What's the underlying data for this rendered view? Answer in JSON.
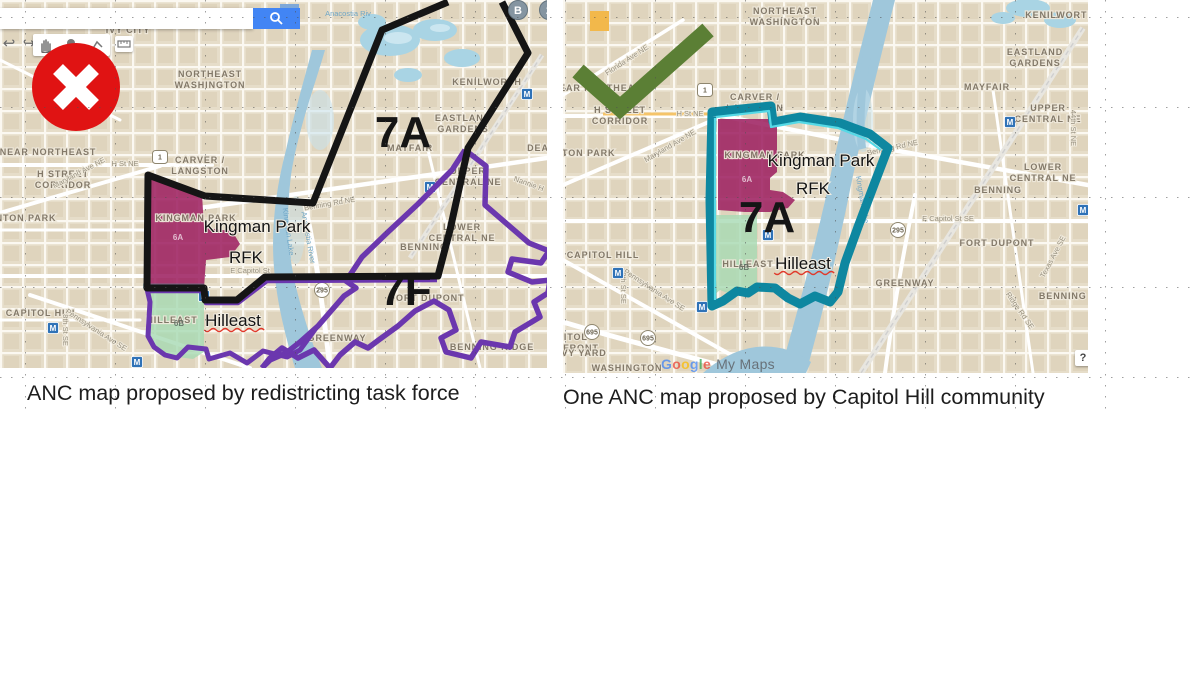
{
  "captions": {
    "left": "ANC map proposed by redistricting task force",
    "right": "One ANC map proposed by Capitol Hill community"
  },
  "verdict_icons": {
    "left": "x-mark",
    "right": "check-mark"
  },
  "colors": {
    "land": "#E6DDC9",
    "water": "#9FC7DB",
    "water_light": "#C6E2EE",
    "black_boundary": "#151515",
    "purple_boundary": "#6B37AE",
    "teal_boundary": "#0E87A0",
    "teal_inner": "#56D9E6",
    "magenta_fill": "#9D2060",
    "green_fill": "#A6D9B3",
    "red_badge": "#E01313",
    "check_green": "#5B7F35",
    "search_blue": "#4285F4",
    "metro_blue": "#2F72B7"
  },
  "search": {
    "button_icon": "magnifier",
    "value": ""
  },
  "toolbar": {
    "icons": [
      "undo-arrow",
      "redo-arrow",
      "hand",
      "marker",
      "draw-line",
      "ruler"
    ]
  },
  "watermark": {
    "brand": "Google",
    "product": "My Maps"
  },
  "help_button": "?",
  "left_map": {
    "title": "Task force proposal",
    "district_labels": [
      {
        "t": "7A",
        "x": 403,
        "y": 147
      },
      {
        "t": "7F",
        "x": 406,
        "y": 305
      }
    ],
    "overlay_labels": [
      {
        "t": "Kingman Park",
        "x": 257,
        "y": 232
      },
      {
        "t": "RFK",
        "x": 246,
        "y": 263
      },
      {
        "t": "Hilleast",
        "x": 233,
        "y": 326,
        "squiggle": true
      }
    ],
    "badges": [
      {
        "t": "6A",
        "x": 178,
        "y": 240,
        "light": true
      },
      {
        "t": "6B",
        "x": 179,
        "y": 326
      }
    ],
    "area_labels": [
      {
        "lines": [
          "IVY CITY"
        ],
        "x": 128,
        "y": 33
      },
      {
        "lines": [
          "NORTHEAST",
          "WASHINGTON"
        ],
        "x": 210,
        "y": 77
      },
      {
        "lines": [
          "KENILWORTH"
        ],
        "x": 487,
        "y": 85
      },
      {
        "lines": [
          "EASTLAND",
          "GARDENS"
        ],
        "x": 463,
        "y": 121
      },
      {
        "lines": [
          "MAYFAIR"
        ],
        "x": 410,
        "y": 151
      },
      {
        "lines": [
          "DEANWOOD"
        ],
        "x": 558,
        "y": 151
      },
      {
        "lines": [
          "NEAR NORTHEAST"
        ],
        "x": 48,
        "y": 155
      },
      {
        "lines": [
          "H STREET",
          "CORRIDOR"
        ],
        "x": 63,
        "y": 177
      },
      {
        "lines": [
          "CARVER /",
          "LANGSTON"
        ],
        "x": 200,
        "y": 163
      },
      {
        "lines": [
          "UPPER",
          "CENTRAL NE"
        ],
        "x": 468,
        "y": 174
      },
      {
        "lines": [
          "STANTON PARK"
        ],
        "x": 16,
        "y": 221
      },
      {
        "lines": [
          "KINGMAN PARK"
        ],
        "x": 196,
        "y": 221
      },
      {
        "lines": [
          "LOWER",
          "CENTRAL NE"
        ],
        "x": 462,
        "y": 230
      },
      {
        "lines": [
          "BENNING"
        ],
        "x": 424,
        "y": 250
      },
      {
        "lines": [
          "CAPITOL HILL"
        ],
        "x": 42,
        "y": 316
      },
      {
        "lines": [
          "FORT DUPONT"
        ],
        "x": 427,
        "y": 301
      },
      {
        "lines": [
          "GREENWAY"
        ],
        "x": 337,
        "y": 341
      },
      {
        "lines": [
          "BENNING RIDGE"
        ],
        "x": 492,
        "y": 350
      },
      {
        "lines": [
          "HILLEAST"
        ],
        "x": 172,
        "y": 323
      }
    ],
    "street_labels": [
      {
        "t": "H St NE",
        "x": 125,
        "y": 166
      },
      {
        "t": "Maryland Ave NE",
        "x": 80,
        "y": 175,
        "r": -28
      },
      {
        "t": "Benning Rd NE",
        "x": 330,
        "y": 206,
        "r": -10
      },
      {
        "t": "E Capitol St",
        "x": 250,
        "y": 273
      },
      {
        "t": "Pennsylvania Ave SE",
        "x": 95,
        "y": 332,
        "r": 33
      },
      {
        "t": "8th St SE",
        "x": 63,
        "y": 330,
        "r": 90
      },
      {
        "t": "Nannie H",
        "x": 528,
        "y": 186,
        "r": 20
      },
      {
        "t": "Anacostia River",
        "x": 306,
        "y": 238,
        "r": 80,
        "c": 1
      },
      {
        "t": "Kingman Lake",
        "x": 286,
        "y": 232,
        "r": 82,
        "c": 1
      },
      {
        "t": "Anacostia Riv",
        "x": 348,
        "y": 16,
        "c": 1
      }
    ],
    "shields": [
      {
        "t": "1",
        "x": 160,
        "y": 157,
        "type": "us"
      },
      {
        "t": "295",
        "x": 322,
        "y": 290,
        "type": "circle"
      }
    ],
    "metro": [
      [
        53,
        328
      ],
      [
        137,
        362
      ],
      [
        204,
        296
      ],
      [
        430,
        187
      ],
      [
        527,
        94
      ]
    ],
    "markers": [
      {
        "t": "B",
        "x": 518,
        "y": 10
      },
      {
        "t": "2",
        "x": 549,
        "y": 10
      }
    ]
  },
  "right_map": {
    "title": "Capitol Hill community proposal",
    "district_labels": [
      {
        "t": "7A",
        "x": 204,
        "y": 232
      }
    ],
    "overlay_labels": [
      {
        "t": "Kingman Park",
        "x": 258,
        "y": 166
      },
      {
        "t": "RFK",
        "x": 250,
        "y": 194
      },
      {
        "t": "Hilleast",
        "x": 240,
        "y": 269,
        "squiggle": true
      }
    ],
    "badges": [
      {
        "t": "6A",
        "x": 184,
        "y": 182,
        "light": true
      },
      {
        "t": "6B",
        "x": 181,
        "y": 270
      }
    ],
    "area_labels": [
      {
        "lines": [
          "NORTHEAST",
          "WASHINGTON"
        ],
        "x": 222,
        "y": 14
      },
      {
        "lines": [
          "KENILWORTH"
        ],
        "x": 497,
        "y": 18
      },
      {
        "lines": [
          "EASTLAND",
          "GARDENS"
        ],
        "x": 472,
        "y": 55
      },
      {
        "lines": [
          "MAYFAIR"
        ],
        "x": 424,
        "y": 90
      },
      {
        "lines": [
          "UPPER",
          "CENTRAL NE"
        ],
        "x": 485,
        "y": 111
      },
      {
        "lines": [
          "NEAR NORTHEAST"
        ],
        "x": 37,
        "y": 91
      },
      {
        "lines": [
          "H STREET",
          "CORRIDOR"
        ],
        "x": 57,
        "y": 113
      },
      {
        "lines": [
          "CARVER /",
          "LANGSTON"
        ],
        "x": 192,
        "y": 100
      },
      {
        "lines": [
          "STANTON PARK"
        ],
        "x": 12,
        "y": 156
      },
      {
        "lines": [
          "KINGMAN PARK"
        ],
        "x": 202,
        "y": 158
      },
      {
        "lines": [
          "LOWER",
          "CENTRAL NE"
        ],
        "x": 480,
        "y": 170
      },
      {
        "lines": [
          "BENNING"
        ],
        "x": 435,
        "y": 193
      },
      {
        "lines": [
          "CAPITOL HILL"
        ],
        "x": 40,
        "y": 258
      },
      {
        "lines": [
          "FORT DUPONT"
        ],
        "x": 434,
        "y": 246
      },
      {
        "lines": [
          "GREENWAY"
        ],
        "x": 342,
        "y": 286
      },
      {
        "lines": [
          "BENNING RIDGE"
        ],
        "x": 518,
        "y": 299
      },
      {
        "lines": [
          "HILLEAST"
        ],
        "x": 185,
        "y": 267
      },
      {
        "lines": [
          "CAPITOL",
          "RIVERFRONT"
        ],
        "x": 2,
        "y": 340
      },
      {
        "lines": [
          "NAVY YARD"
        ],
        "x": 14,
        "y": 356
      },
      {
        "lines": [
          "WASHINGTON"
        ],
        "x": 64,
        "y": 371
      }
    ],
    "street_labels": [
      {
        "t": "Florida Ave NE",
        "x": 65,
        "y": 62,
        "r": -33
      },
      {
        "t": "H St NE",
        "x": 127,
        "y": 116
      },
      {
        "t": "Maryland Ave NE",
        "x": 108,
        "y": 148,
        "r": -30
      },
      {
        "t": "Benning Rd NE",
        "x": 330,
        "y": 150,
        "r": -12
      },
      {
        "t": "44th St NE",
        "x": 508,
        "y": 128,
        "r": 90
      },
      {
        "t": "E Capitol St SE",
        "x": 385,
        "y": 221
      },
      {
        "t": "Texas Ave SE",
        "x": 492,
        "y": 258,
        "r": -62
      },
      {
        "t": "Ridge Rd SE",
        "x": 455,
        "y": 312,
        "r": 55
      },
      {
        "t": "Pennsylvania Ave SE",
        "x": 90,
        "y": 292,
        "r": 33
      },
      {
        "t": "8th St SE",
        "x": 58,
        "y": 288,
        "r": 90
      },
      {
        "t": "Kingman Lake",
        "x": 297,
        "y": 200,
        "r": 80,
        "c": 1
      }
    ],
    "shields": [
      {
        "t": "1",
        "x": 142,
        "y": 90,
        "type": "us"
      },
      {
        "t": "295",
        "x": 335,
        "y": 230,
        "type": "circle"
      },
      {
        "t": "695",
        "x": 29,
        "y": 332,
        "type": "circle"
      },
      {
        "t": "695",
        "x": 85,
        "y": 338,
        "type": "circle"
      }
    ],
    "metro": [
      [
        447,
        122
      ],
      [
        205,
        235
      ],
      [
        55,
        273
      ],
      [
        139,
        307
      ],
      [
        520,
        210
      ]
    ],
    "markers": []
  }
}
